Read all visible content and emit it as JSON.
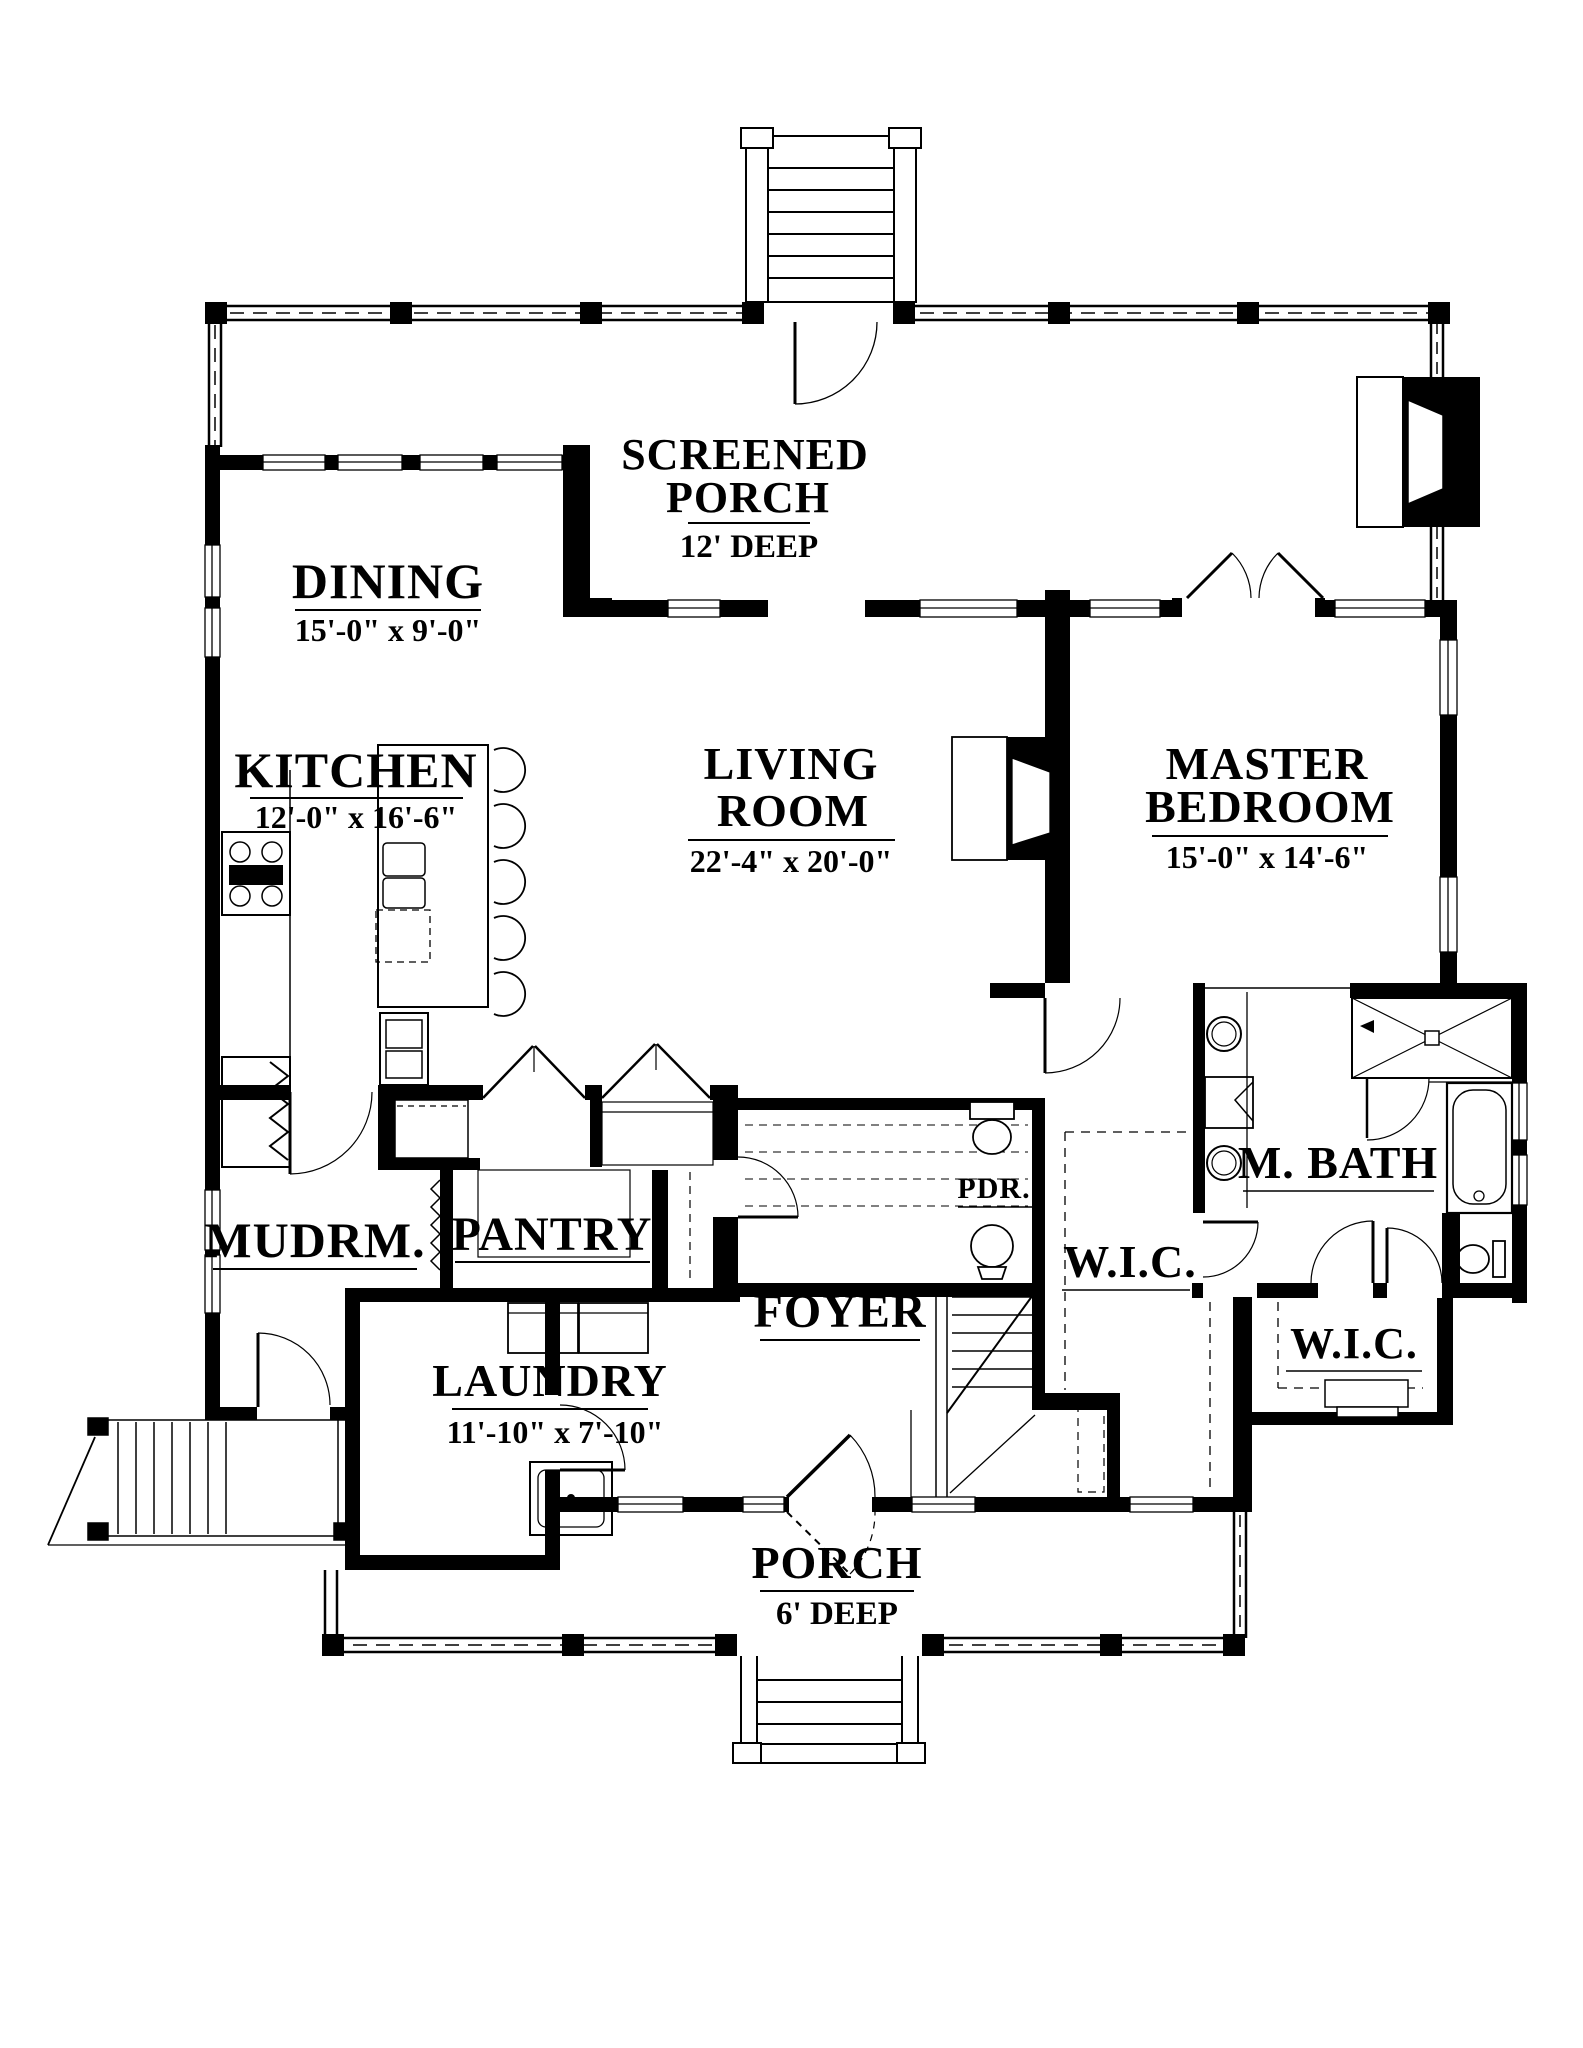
{
  "page": {
    "background": "#ffffff",
    "line_color": "#000000"
  },
  "plan": {
    "rooms": {
      "screened_porch": {
        "line1": "SCREENED",
        "line2": "PORCH",
        "dim": "12' DEEP"
      },
      "dining": {
        "name": "DINING",
        "dim": "15'-0\" x 9'-0\""
      },
      "kitchen": {
        "name": "KITCHEN",
        "dim": "12'-0\" x 16'-6\""
      },
      "living_room": {
        "line1": "LIVING",
        "line2": "ROOM",
        "dim": "22'-4\" x 20'-0\""
      },
      "master_bedroom": {
        "line1": "MASTER",
        "line2": "BEDROOM",
        "dim": "15'-0\" x 14'-6\""
      },
      "mudroom": {
        "name": "MUDRM."
      },
      "pantry": {
        "name": "PANTRY"
      },
      "powder_room": {
        "name": "PDR."
      },
      "foyer": {
        "name": "FOYER"
      },
      "wic_hall": {
        "name": "W.I.C."
      },
      "master_bath": {
        "name": "M. BATH"
      },
      "wic_rear": {
        "name": "W.I.C."
      },
      "laundry": {
        "name": "LAUNDRY",
        "dim": "11'-10\" x 7'-10\""
      },
      "front_porch": {
        "name": "PORCH",
        "dim": "6' DEEP"
      }
    }
  }
}
